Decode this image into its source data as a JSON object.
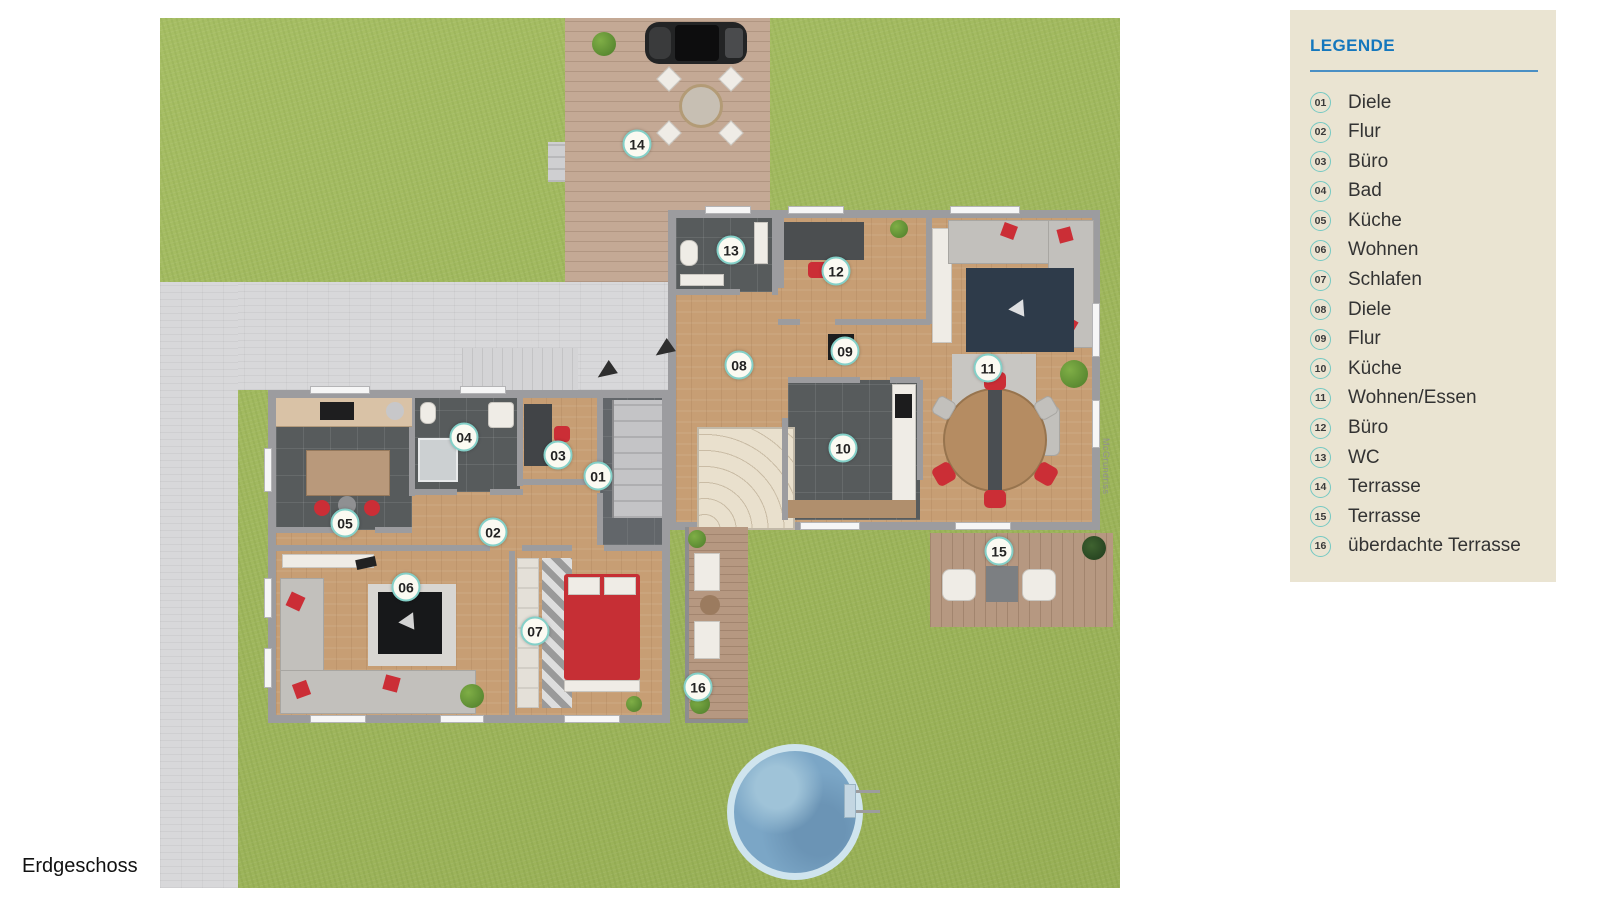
{
  "page": {
    "floor_label": "Erdgeschoss",
    "watermark": "McGrundriss"
  },
  "colors": {
    "legend_title_blue": "#1477bd",
    "badge_ring_teal": "#84d0c8",
    "legend_panel_bg": "#eae4d2",
    "grass_green": "#a2bb5c"
  },
  "legend": {
    "title": "LEGENDE",
    "items": [
      {
        "num": "01",
        "label": "Diele"
      },
      {
        "num": "02",
        "label": "Flur"
      },
      {
        "num": "03",
        "label": "Büro"
      },
      {
        "num": "04",
        "label": "Bad"
      },
      {
        "num": "05",
        "label": "Küche"
      },
      {
        "num": "06",
        "label": "Wohnen"
      },
      {
        "num": "07",
        "label": "Schlafen"
      },
      {
        "num": "08",
        "label": "Diele"
      },
      {
        "num": "09",
        "label": "Flur"
      },
      {
        "num": "10",
        "label": "Küche"
      },
      {
        "num": "11",
        "label": "Wohnen/Essen"
      },
      {
        "num": "12",
        "label": "Büro"
      },
      {
        "num": "13",
        "label": "WC"
      },
      {
        "num": "14",
        "label": "Terrasse"
      },
      {
        "num": "15",
        "label": "Terrasse"
      },
      {
        "num": "16",
        "label": "überdachte Terrasse"
      }
    ]
  }
}
